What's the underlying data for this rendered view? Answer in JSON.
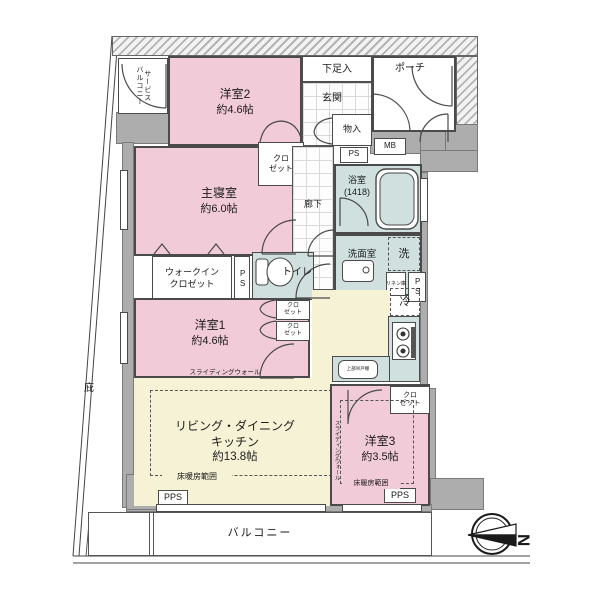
{
  "plan_title": "floor-plan",
  "colors": {
    "room_pink": "#f2cbd8",
    "room_cream": "#f6f2d6",
    "room_wet": "#cfe0df",
    "wall_gray": "#adadad",
    "line": "#4a4a4a"
  },
  "rooms": {
    "service_balcony": "サービス\nバルコニー",
    "yoshitsu2_name": "洋室2",
    "yoshitsu2_size": "約4.6帖",
    "shoebox": "下足入",
    "entrance": "玄関",
    "porch": "ポーチ",
    "storage": "物入",
    "mb": "MB",
    "ps": "PS",
    "pps": "PPS",
    "closet": "クロ\nゼット",
    "master_name": "主寝室",
    "master_size": "約6.0帖",
    "hall": "廊下",
    "bath_name": "浴室",
    "bath_size": "(1418)",
    "washroom": "洗面室",
    "washer": "洗",
    "linen": "リネン庫",
    "wic": "ウォークイン\nクロゼット",
    "toilet": "トイレ",
    "y1_name": "洋室1",
    "y1_size": "約4.6帖",
    "sliding_wall": "スライディングウォール",
    "eaves": "庇",
    "ldk_line1": "リビング・ダイニング",
    "ldk_line2": "キッチン",
    "ldk_size": "約13.8帖",
    "floor_heating": "床暖房範囲",
    "fridge": "冷",
    "cabinet": "上部吊戸棚",
    "y3_name": "洋室3",
    "y3_size": "約3.5帖",
    "balcony": "バルコニー",
    "compass_n": "N"
  }
}
